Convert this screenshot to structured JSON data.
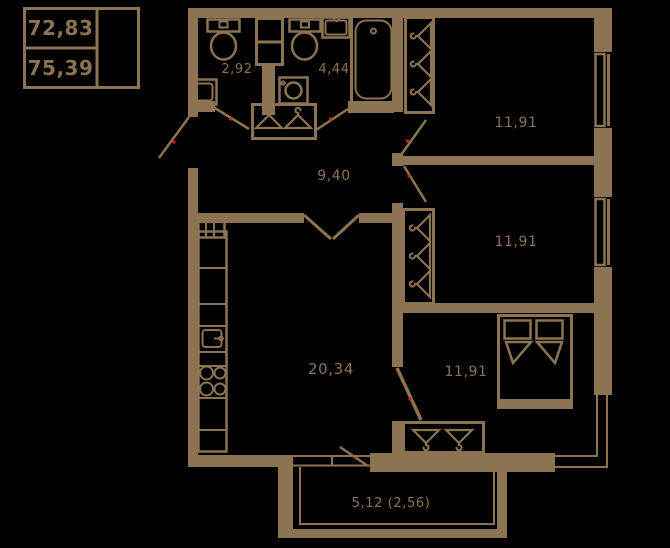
{
  "legend": {
    "area_total": "72,83",
    "area_reduced": "75,39"
  },
  "rooms": {
    "wc": {
      "area": "2,92"
    },
    "bathroom": {
      "area": "4,44"
    },
    "hallway": {
      "area": "9,40"
    },
    "bedroom_top": {
      "area": "11,91"
    },
    "bedroom_middle": {
      "area": "11,91"
    },
    "bedroom_bottom": {
      "area": "11,91"
    },
    "living_kitchen": {
      "area": "20,34"
    },
    "balcony": {
      "area": "5,12 (2,56)"
    }
  },
  "colors": {
    "background": "#000000",
    "plan_line": "#8c7352",
    "door_marker_red": "#c9251c"
  },
  "icons": {
    "hanger-icon": "triangle-with-hook",
    "toilet-icon": "tank-plus-bowl",
    "bathtub-icon": "rounded-tub-with-drain",
    "washing-machine-icon": "square-with-drum-circle",
    "sink-icon": "rect-basin",
    "kitchen-sink-icon": "rect-basin-with-tap",
    "stove-icon": "four-burner-circles",
    "bed-icon": "double-bed-two-pillows",
    "window-icon": "double-parallel-lines",
    "door-swing-icon": "diagonal-leaf-line"
  }
}
